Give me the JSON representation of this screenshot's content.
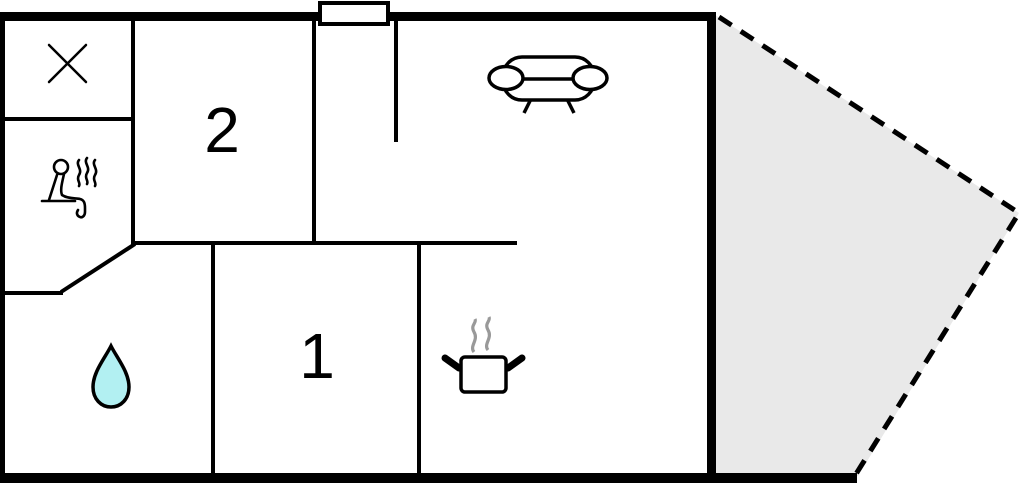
{
  "floor_plan": {
    "type": "floor-plan",
    "rooms": [
      {
        "id": "room-2",
        "label": "2"
      },
      {
        "id": "room-1",
        "label": "1"
      }
    ],
    "icons": [
      {
        "name": "closet-x-icon",
        "meaning": "wardrobe/closet cross mark"
      },
      {
        "name": "sauna-icon",
        "meaning": "person in sauna with steam"
      },
      {
        "name": "water-drop-icon",
        "meaning": "bathroom / water"
      },
      {
        "name": "sofa-icon",
        "meaning": "living room couch"
      },
      {
        "name": "cooking-pot-icon",
        "meaning": "kitchen pot with steam"
      },
      {
        "name": "chimney-marker",
        "meaning": "chimney / vent block on top wall"
      }
    ],
    "areas": [
      {
        "name": "terrace",
        "style": "dashed-outline-gray-fill"
      }
    ],
    "colors": {
      "wall": "#000000",
      "background": "#ffffff",
      "terrace_fill": "#e9e9e9",
      "water_drop_fill": "#b2f0f2",
      "steam_gray": "#999999"
    }
  }
}
